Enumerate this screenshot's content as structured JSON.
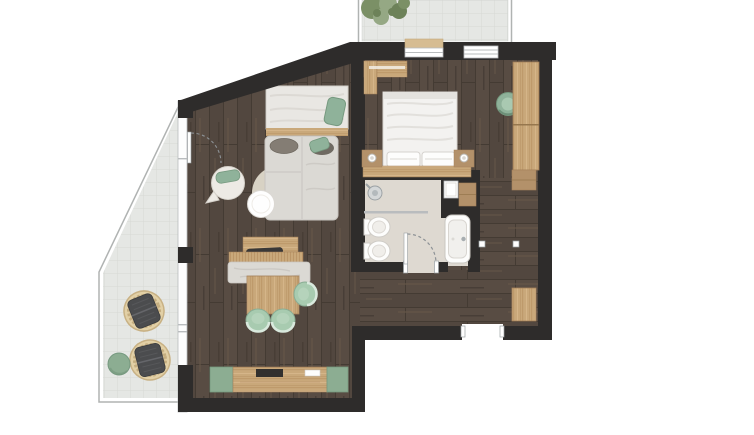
{
  "document": {
    "kind": "floor-plan",
    "text_labels": []
  },
  "colors": {
    "wall": "#2e2c2b",
    "plank_a": "#584c43",
    "plank_b": "#52473f",
    "plank_joint": "#443b33",
    "plank_streak_light": "#655749",
    "plank_streak_dark": "#3e352e",
    "terrace_tile": "#e5e7e4",
    "terrace_grout": "#d6d9d5",
    "terrace_edge": "#b0b3b2",
    "bath_floor": "#ded9d1",
    "oak_a": "#c9a87a",
    "oak_b": "#bb9668",
    "oak_c": "#d6b78b",
    "oak_edge": "#a5815a",
    "oak_dark": "#b3916a",
    "green_chair": "#a8cbb0",
    "green_chair_edge": "#8aad94",
    "green_soft": "#8fb29a",
    "green_dark_edge": "#76997f",
    "green_cabinet": "#8cad92",
    "sofa_gray": "#dbd9d4",
    "sofa_edge": "#c7c4bf",
    "bed_white": "#f3f2f0",
    "pillow_gray": "#847d74",
    "cushion_dark": "#4b4c4e",
    "wicker": "#e2d0a6",
    "wicker_edge": "#c8b184",
    "rug": "#d8d2c4",
    "fixture_white": "#fdfdfc",
    "fixture_edge": "#cfccc7",
    "glass_frame": "#b9bcbe",
    "door_arc": "#8d9296",
    "window_sill_tan": "#d6bc92",
    "plant_dark": "#6d8259",
    "plant_mid": "#7b9066",
    "plant_light": "#95a884",
    "tv_dark": "#32302e"
  },
  "rooms": [
    {
      "name": "living-area"
    },
    {
      "name": "bedroom"
    },
    {
      "name": "bathroom"
    },
    {
      "name": "hallway"
    },
    {
      "name": "entry"
    },
    {
      "name": "terrace"
    },
    {
      "name": "balcony"
    }
  ],
  "furniture": [
    "double-bed",
    "nightstand-left",
    "nightstand-right",
    "wardrobe",
    "bedroom-chair",
    "window-bench",
    "daybed",
    "lounge-sofa",
    "round-armchair",
    "round-table",
    "round-rug",
    "dining-table",
    "dining-bench",
    "console",
    "dining-chair",
    "media-sideboard",
    "tv",
    "shower",
    "bidet",
    "toilet",
    "bathtub",
    "wall-niche",
    "bath-cabinet",
    "hall-cabinet",
    "entry-bench",
    "wicker-lounge-chair",
    "side-pouf",
    "potted-plant"
  ]
}
